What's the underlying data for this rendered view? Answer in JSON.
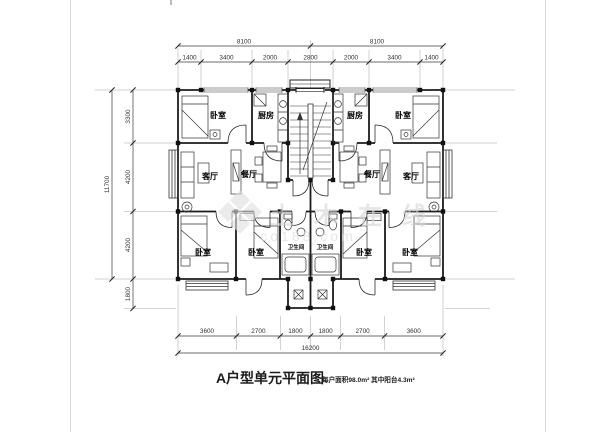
{
  "title": {
    "main": "A户型单元平面图",
    "sub": "每户面积98.0m² 其中阳台4.3m²"
  },
  "watermark": {
    "name": "土木在线",
    "domain": "co188.com"
  },
  "room_labels": {
    "bedroom": "卧室",
    "kitchen": "厨房",
    "living_room": "客厅",
    "dining_room": "餐厅",
    "bathroom": "卫生间"
  },
  "dimensions": {
    "top_overall": [
      "8100",
      "8100"
    ],
    "top_segments": [
      "1400",
      "3400",
      "2000",
      "2800",
      "2000",
      "3400",
      "1400"
    ],
    "left_overall": "11700",
    "left_segments": [
      "3300",
      "4200",
      "4200",
      "1800"
    ],
    "bottom_segments": [
      "3600",
      "2700",
      "1800",
      "1800",
      "2700",
      "3600"
    ],
    "bottom_overall": "16200"
  },
  "colors": {
    "ink": "#1c1c1c",
    "dim_line": "#3a3a3a",
    "grid": "#9a9a9a",
    "watermark": "#d6d6d6",
    "paper": "#ffffff"
  }
}
